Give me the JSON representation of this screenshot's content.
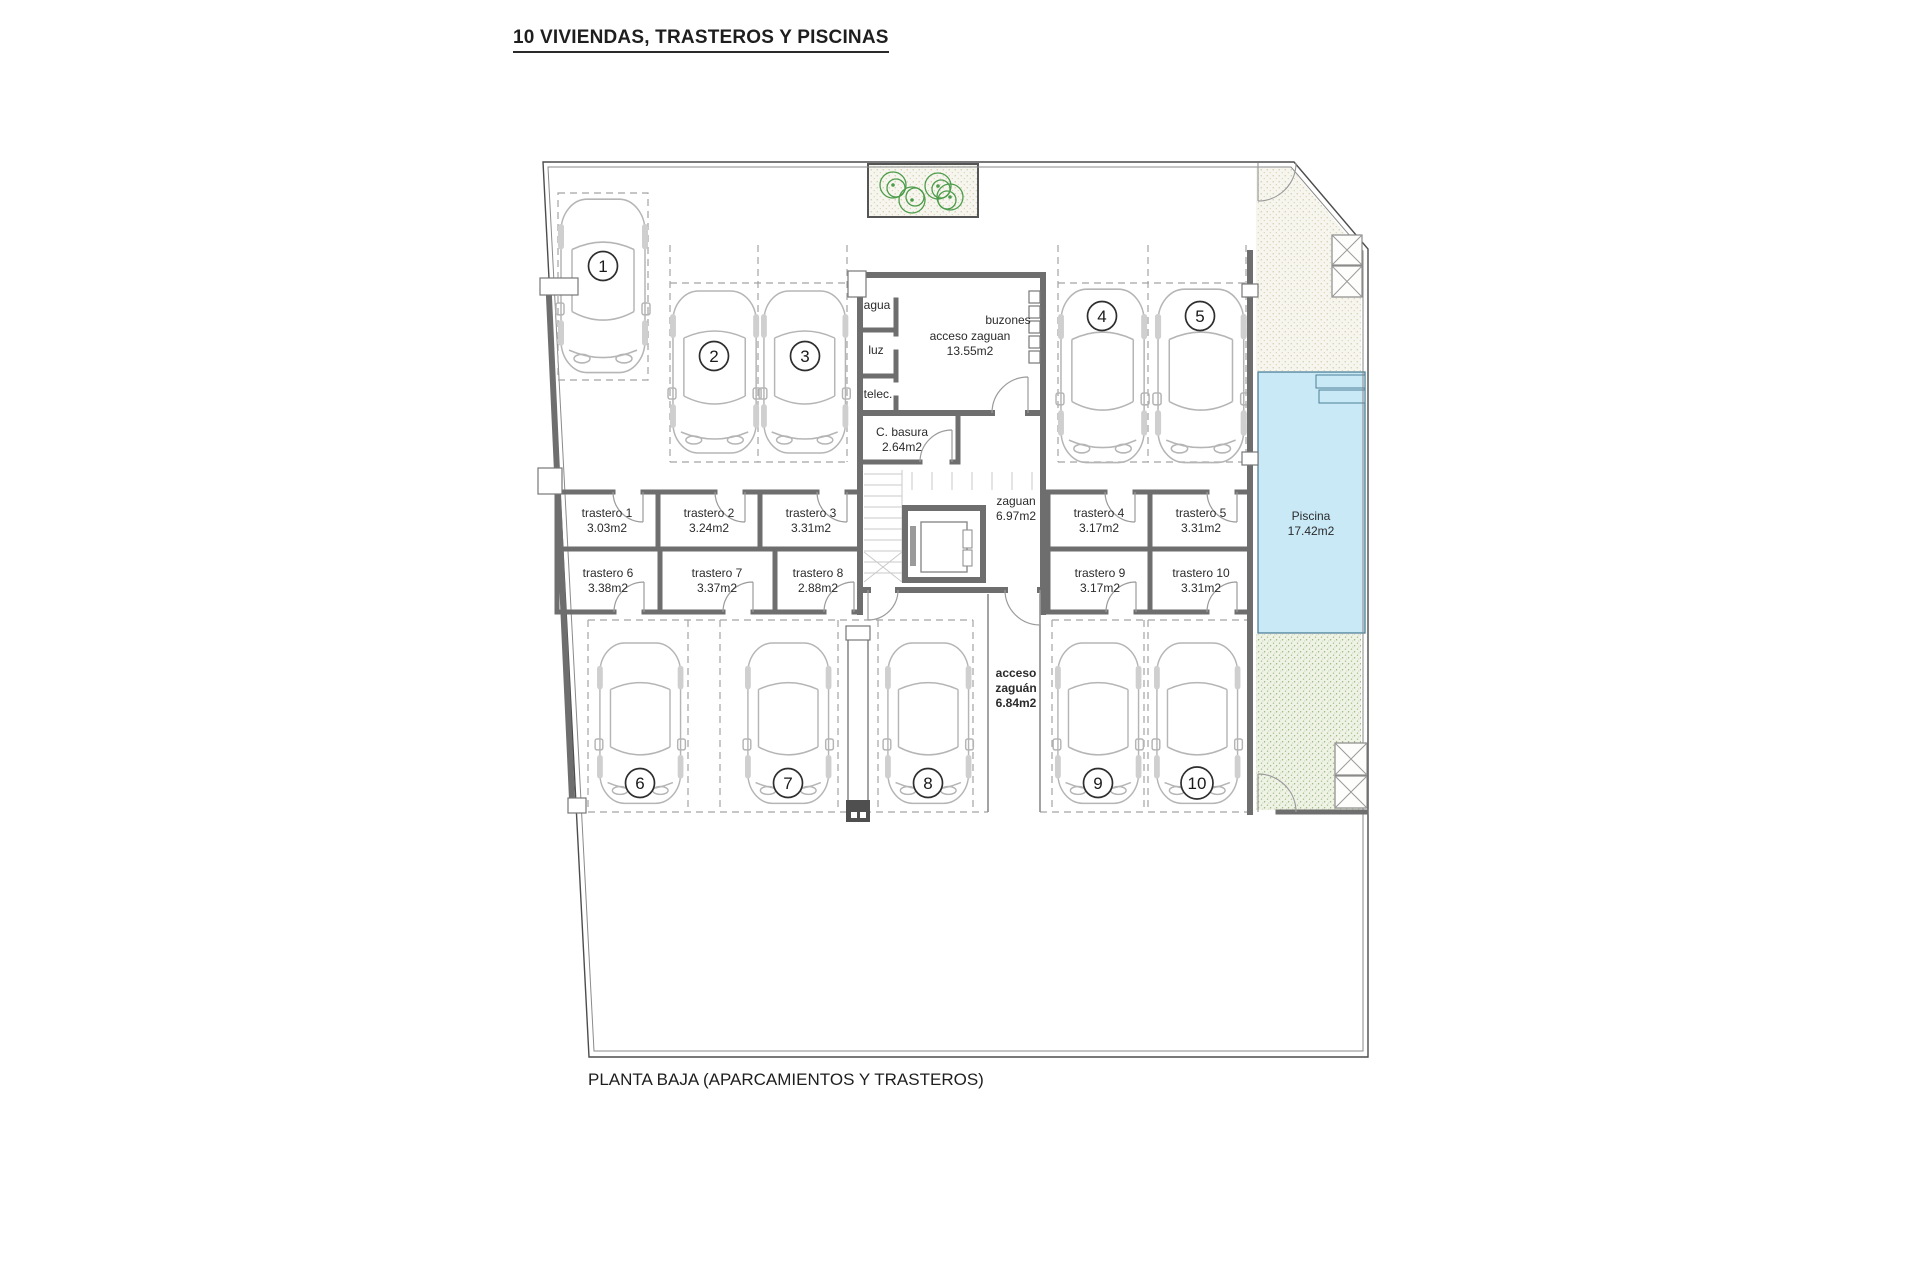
{
  "title": "10 VIVIENDAS, TRASTEROS Y PISCINAS",
  "caption": "PLANTA BAJA (APARCAMIENTOS Y TRASTEROS)",
  "plan": {
    "parking": [
      {
        "number": "1"
      },
      {
        "number": "2"
      },
      {
        "number": "3"
      },
      {
        "number": "4"
      },
      {
        "number": "5"
      },
      {
        "number": "6"
      },
      {
        "number": "7"
      },
      {
        "number": "8"
      },
      {
        "number": "9"
      },
      {
        "number": "10"
      }
    ],
    "trasteros": [
      {
        "name": "trastero 1",
        "area": "3.03m2"
      },
      {
        "name": "trastero 2",
        "area": "3.24m2"
      },
      {
        "name": "trastero 3",
        "area": "3.31m2"
      },
      {
        "name": "trastero 4",
        "area": "3.17m2"
      },
      {
        "name": "trastero 5",
        "area": "3.31m2"
      },
      {
        "name": "trastero 6",
        "area": "3.38m2"
      },
      {
        "name": "trastero 7",
        "area": "3.37m2"
      },
      {
        "name": "trastero 8",
        "area": "2.88m2"
      },
      {
        "name": "trastero 9",
        "area": "3.17m2"
      },
      {
        "name": "trastero 10",
        "area": "3.31m2"
      }
    ],
    "utility_rooms": {
      "agua": "agua",
      "luz": "luz",
      "telec": "telec."
    },
    "entrance_hall": {
      "name": "acceso zaguan",
      "area": "13.55m2"
    },
    "mailboxes_label": "buzones",
    "trash_room": {
      "name": "C. basura",
      "area": "2.64m2"
    },
    "lobby": {
      "name": "zaguan",
      "area": "6.97m2"
    },
    "access_corridor": {
      "line1": "acceso",
      "line2": "zaguán",
      "line3": "6.84m2"
    },
    "pool": {
      "name": "Piscina",
      "area": "17.42m2"
    },
    "colors": {
      "pool_fill": "#c9e9f7",
      "wall": "#6e6e6e",
      "garden_speckle": "#8fae6f",
      "terrace_speckle": "#cbc5a6",
      "plant_green": "#4d9c4b"
    }
  }
}
